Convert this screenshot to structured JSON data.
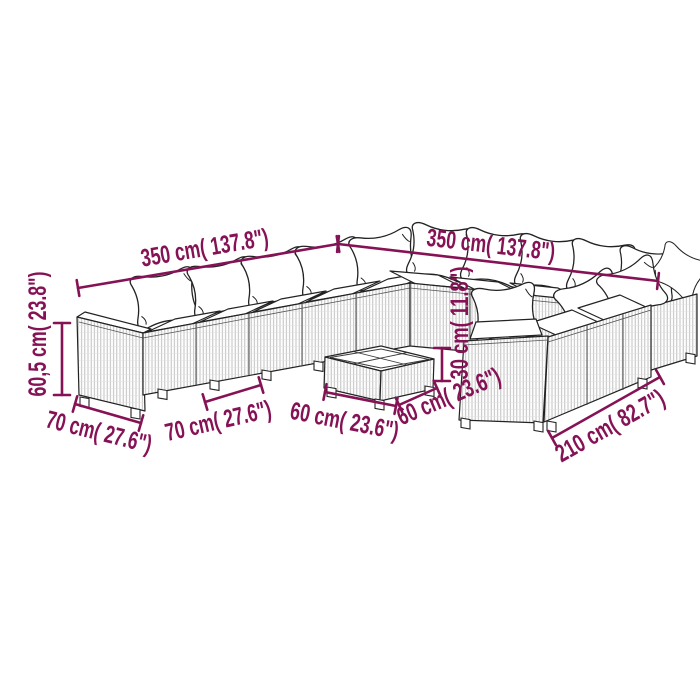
{
  "page": {
    "background": "#ffffff"
  },
  "diagram": {
    "accent_color": "#861256",
    "line_color": "#232323",
    "dimensions": [
      {
        "id": "wing-left-length",
        "label": "350 cm( 137.8\")"
      },
      {
        "id": "wing-right-length",
        "label": "350 cm( 137.8\")"
      },
      {
        "id": "sofa-height",
        "label": "60,5 cm( 23.8\")"
      },
      {
        "id": "armrest-depth",
        "label": "70 cm( 27.6\")"
      },
      {
        "id": "seat-module-width",
        "label": "70 cm( 27.6\")"
      },
      {
        "id": "table-width",
        "label": "60 cm( 23.6\")"
      },
      {
        "id": "table-depth",
        "label": "60 cm( 23.6\")"
      },
      {
        "id": "table-height",
        "label": "30 cm( 11.8\")"
      },
      {
        "id": "right-wing-length",
        "label": "210 cm( 82.7\")"
      }
    ]
  }
}
